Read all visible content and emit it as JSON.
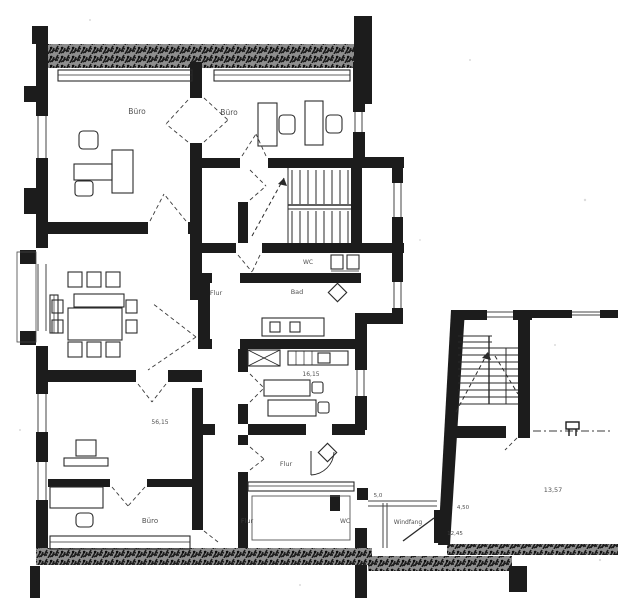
{
  "document": {
    "kind": "scanned architectural floor plan",
    "palette": {
      "paper": "#ffffff",
      "ink": "#1e1e1e",
      "wall_hatch_base": "#8e8e8e",
      "faint": "#3d3d3d"
    }
  },
  "labels": {
    "office_top_left": "Büro",
    "office_top_mid": "Büro",
    "corridor_mid": "Flur",
    "bath": "Bad",
    "wc_upper": "WC",
    "kitchen_area": "16,15",
    "office_lower_area": "56,15",
    "office_bottom_left": "Büro",
    "corridor_lower": "Flur",
    "hall_lower": "Flur",
    "wc_entrance": "WC",
    "vestibule": "Windfang",
    "dim_small": "5,0",
    "dim_entry_width": "4,50",
    "dim_entry_len": "12,45",
    "annex_area": "13,57"
  }
}
